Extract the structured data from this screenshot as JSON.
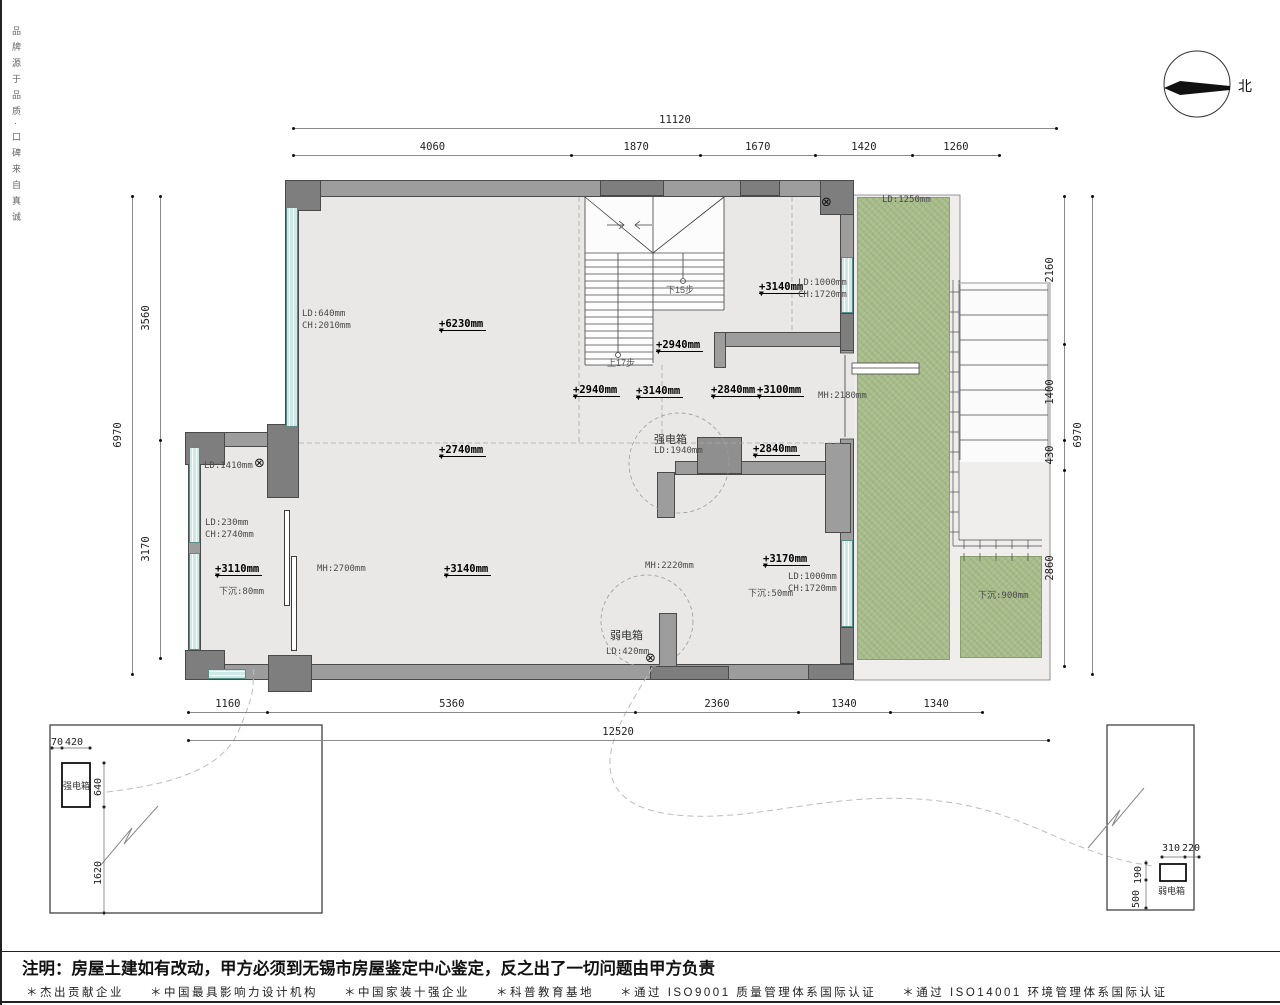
{
  "meta": {
    "brand_vertical": "品牌源于品质·口碑来自真诚",
    "north_label": "北"
  },
  "note": "注明：房屋土建如有改动，甲方必须到无锡市房屋鉴定中心鉴定，反之出了一切问题由甲方负责",
  "footer": {
    "items": [
      "＊杰出贡献企业",
      "＊中国最具影响力设计机构",
      "＊中国家装十强企业",
      "＊科普教育基地",
      "＊通过 ISO9001 质量管理体系国际认证",
      "＊通过 ISO14001 环境管理体系国际认证"
    ]
  },
  "dimensions": {
    "top": {
      "overall": 11120,
      "segments": [
        4060,
        1870,
        1670,
        1420,
        1260
      ]
    },
    "bottom": {
      "overall": 12520,
      "segments": [
        1160,
        5360,
        2360,
        1340,
        1340
      ]
    },
    "left": {
      "overall": 6970,
      "segments": [
        3560,
        3170
      ]
    },
    "right": {
      "overall": 6970,
      "segments": [
        2160,
        1400,
        430,
        2860
      ]
    }
  },
  "callouts": {
    "left_box": {
      "device": "强电箱",
      "dims_h": [
        "70",
        "420"
      ],
      "dims_v": [
        "640",
        "1620"
      ]
    },
    "right_box": {
      "device": "弱电箱",
      "dims_h": [
        "310",
        "220"
      ],
      "dims_v": [
        "190",
        "500"
      ]
    }
  },
  "stairs": {
    "down_label": "下15步",
    "up_label": "上17步"
  },
  "plan_labels": [
    {
      "k": "info",
      "t": "LD:640mm",
      "x": 300,
      "y": 309
    },
    {
      "k": "info",
      "t": "CH:2010mm",
      "x": 300,
      "y": 321
    },
    {
      "k": "elev",
      "t": "+6230mm",
      "x": 437,
      "y": 318
    },
    {
      "k": "elev",
      "t": "+3140mm",
      "x": 757,
      "y": 281
    },
    {
      "k": "info",
      "t": "LD:1000mm",
      "x": 796,
      "y": 278
    },
    {
      "k": "info",
      "t": "CH:1720mm",
      "x": 796,
      "y": 290
    },
    {
      "k": "stairlbl",
      "t": "下15步",
      "x": 664,
      "y": 283
    },
    {
      "k": "elev",
      "t": "+2940mm",
      "x": 654,
      "y": 339
    },
    {
      "k": "stairlbl",
      "t": "上17步",
      "x": 605,
      "y": 356
    },
    {
      "k": "elev",
      "t": "+2940mm",
      "x": 571,
      "y": 384
    },
    {
      "k": "elev",
      "t": "+3140mm",
      "x": 634,
      "y": 385
    },
    {
      "k": "elev",
      "t": "+2840mm",
      "x": 709,
      "y": 384
    },
    {
      "k": "elev",
      "t": "+3100mm",
      "x": 755,
      "y": 384
    },
    {
      "k": "info",
      "t": "MH:2180mm",
      "x": 816,
      "y": 391
    },
    {
      "k": "elev",
      "t": "+2740mm",
      "x": 437,
      "y": 444
    },
    {
      "k": "room",
      "t": "强电箱",
      "x": 652,
      "y": 431
    },
    {
      "k": "info",
      "t": "LD:1940mm",
      "x": 652,
      "y": 446
    },
    {
      "k": "elev",
      "t": "+2840mm",
      "x": 751,
      "y": 443
    },
    {
      "k": "info",
      "t": "LD:1410mm",
      "x": 202,
      "y": 461
    },
    {
      "k": "info",
      "t": "LD:230mm",
      "x": 203,
      "y": 518
    },
    {
      "k": "info",
      "t": "CH:2740mm",
      "x": 203,
      "y": 530
    },
    {
      "k": "elev",
      "t": "+3110mm",
      "x": 213,
      "y": 563
    },
    {
      "k": "info",
      "t": "下沉:80mm",
      "x": 217,
      "y": 584
    },
    {
      "k": "info",
      "t": "MH:2700mm",
      "x": 315,
      "y": 564
    },
    {
      "k": "elev",
      "t": "+3140mm",
      "x": 442,
      "y": 563
    },
    {
      "k": "info",
      "t": "MH:2220mm",
      "x": 643,
      "y": 561
    },
    {
      "k": "elev",
      "t": "+3170mm",
      "x": 761,
      "y": 553
    },
    {
      "k": "info",
      "t": "下沉:50mm",
      "x": 746,
      "y": 586
    },
    {
      "k": "info",
      "t": "LD:1000mm",
      "x": 786,
      "y": 572
    },
    {
      "k": "info",
      "t": "CH:1720mm",
      "x": 786,
      "y": 584
    },
    {
      "k": "room",
      "t": "弱电箱",
      "x": 608,
      "y": 627
    },
    {
      "k": "info",
      "t": "LD:420mm",
      "x": 604,
      "y": 647
    },
    {
      "k": "info",
      "t": "LD:1250mm",
      "x": 880,
      "y": 195
    },
    {
      "k": "info",
      "t": "下沉:900mm",
      "x": 976,
      "y": 588
    },
    {
      "k": "mark",
      "t": "⊗",
      "x": 819,
      "y": 196
    },
    {
      "k": "mark",
      "t": "⊗",
      "x": 252,
      "y": 457
    },
    {
      "k": "mark",
      "t": "⊗",
      "x": 643,
      "y": 652
    },
    {
      "k": "dimtx",
      "t": "70",
      "x": 49,
      "y": 737
    },
    {
      "k": "dimtx",
      "t": "420",
      "x": 63,
      "y": 737
    },
    {
      "k": "dimv",
      "t": "640",
      "x": 91,
      "y": 796
    },
    {
      "k": "dimv",
      "t": "1620",
      "x": 91,
      "y": 885
    },
    {
      "k": "room-s",
      "t": "强电箱",
      "x": 61,
      "y": 779
    },
    {
      "k": "dimtx",
      "t": "310",
      "x": 1160,
      "y": 843
    },
    {
      "k": "dimtx",
      "t": "220",
      "x": 1180,
      "y": 843
    },
    {
      "k": "dimv",
      "t": "190",
      "x": 1131,
      "y": 884
    },
    {
      "k": "dimv",
      "t": "500",
      "x": 1129,
      "y": 908
    },
    {
      "k": "room-s",
      "t": "弱电箱",
      "x": 1156,
      "y": 884
    }
  ],
  "colors": {
    "wall": "#9d9d9d",
    "wall_dark": "#7e7e7e",
    "window": "#cde9e5",
    "green": "#a9bd8c",
    "floor": "#e9e8e7",
    "terrace": "#efeeed",
    "line": "#3e3e3e"
  }
}
